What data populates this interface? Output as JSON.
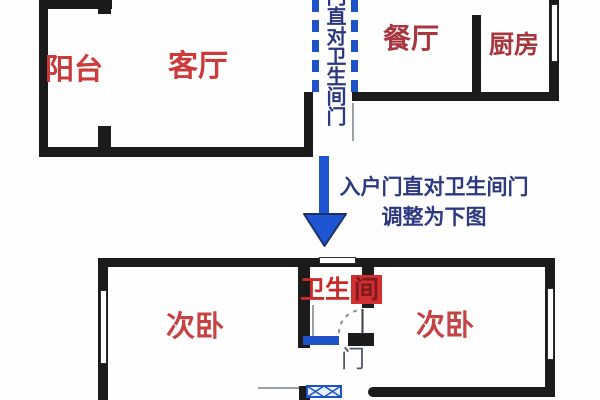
{
  "palette": {
    "wall": "#1b1b1b",
    "label_red": "#cd3a3a",
    "label_red_dark": "#a8363f",
    "highlight_red": "#d22f2f",
    "blue": "#1d52c8",
    "navy_text": "#2c3880",
    "gray_line": "#9aa0a8"
  },
  "top_plan": {
    "rooms": [
      {
        "id": "balcony",
        "label": "阳台"
      },
      {
        "id": "living-room",
        "label": "客厅"
      },
      {
        "id": "dining-room",
        "label": "餐厅"
      },
      {
        "id": "kitchen",
        "label": "厨房"
      }
    ],
    "door_path_note_vertical": "门直对卫生间门"
  },
  "annotation": {
    "line1": "入户门直对卫生间门",
    "line2": "调整为下图"
  },
  "bottom_plan": {
    "rooms": [
      {
        "id": "bedroom-left",
        "label": "次卧"
      },
      {
        "id": "bedroom-right",
        "label": "次卧"
      }
    ],
    "bathroom": {
      "full_label": "卫生间",
      "label_prefix": "卫生",
      "label_highlight": "间"
    },
    "door_label": "门"
  }
}
